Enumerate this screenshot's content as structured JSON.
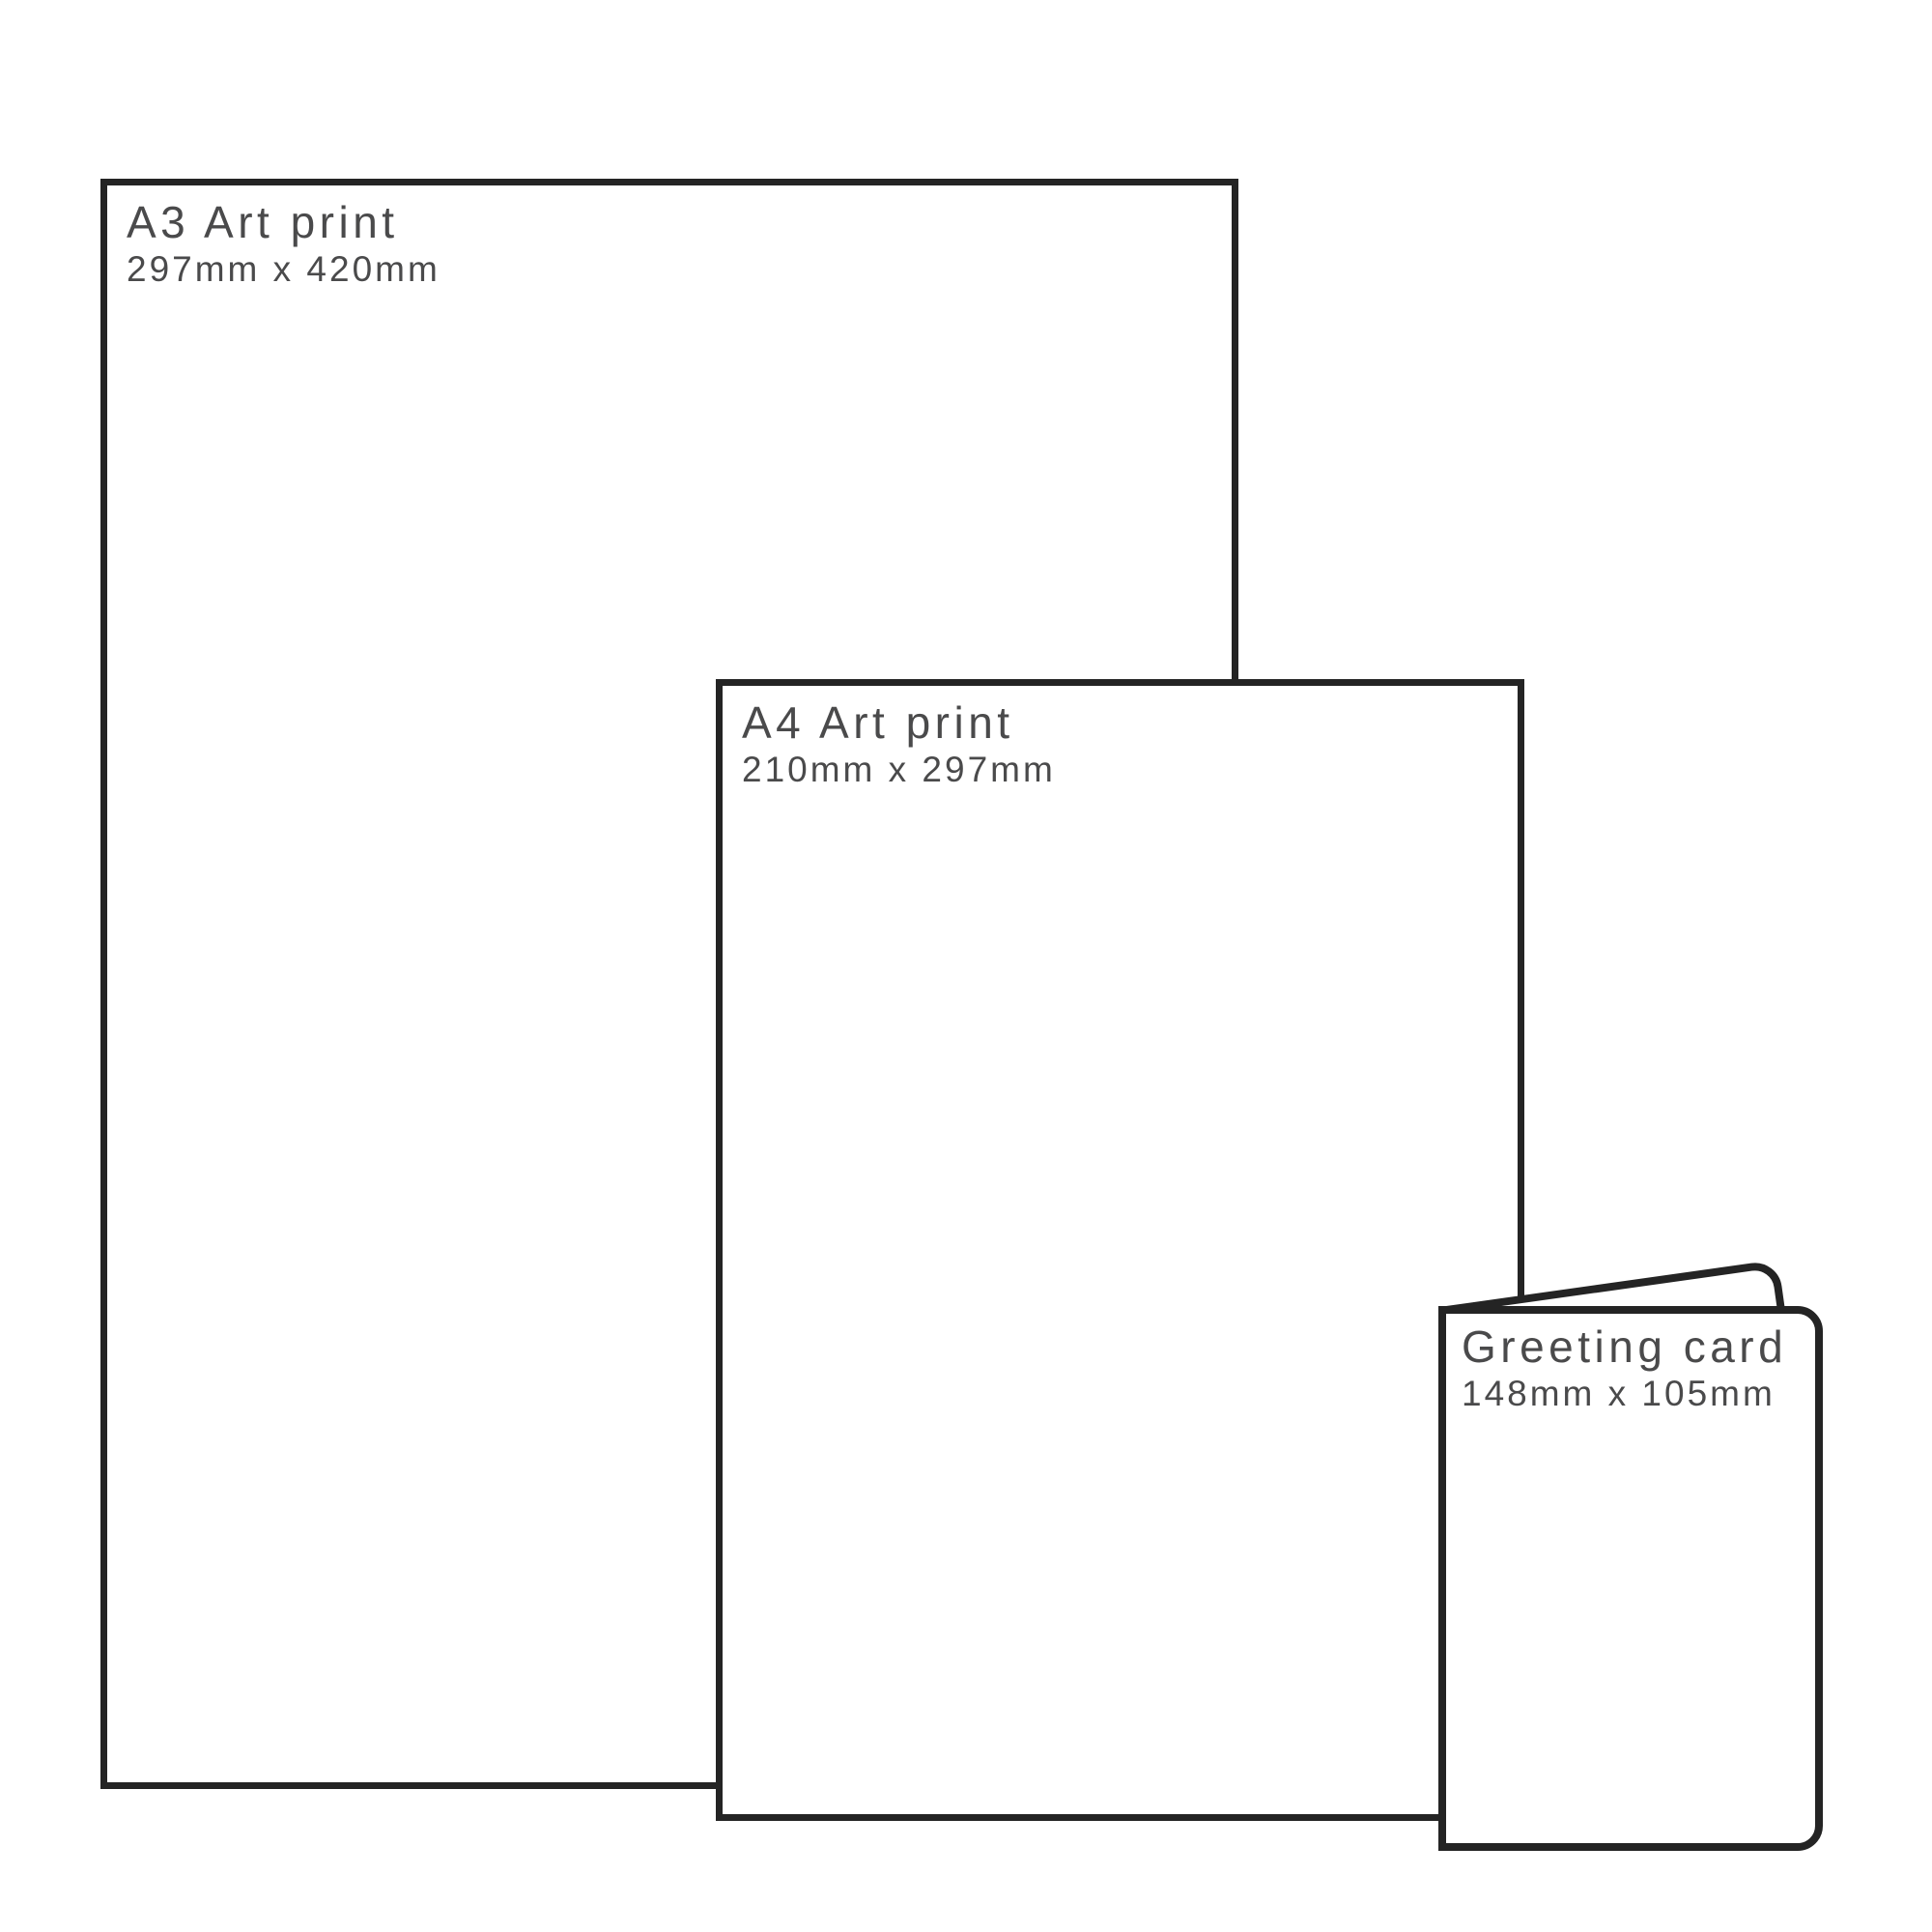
{
  "diagram": {
    "background_color": "#ffffff",
    "outline_color": "#242424",
    "label_color": "#4a4a4b"
  },
  "products": [
    {
      "title": "A3 Art print",
      "dimensions": "297mm x 420mm"
    },
    {
      "title": "A4 Art print",
      "dimensions": "210mm x 297mm"
    },
    {
      "title": "Greeting card",
      "dimensions": "148mm x 105mm"
    }
  ]
}
